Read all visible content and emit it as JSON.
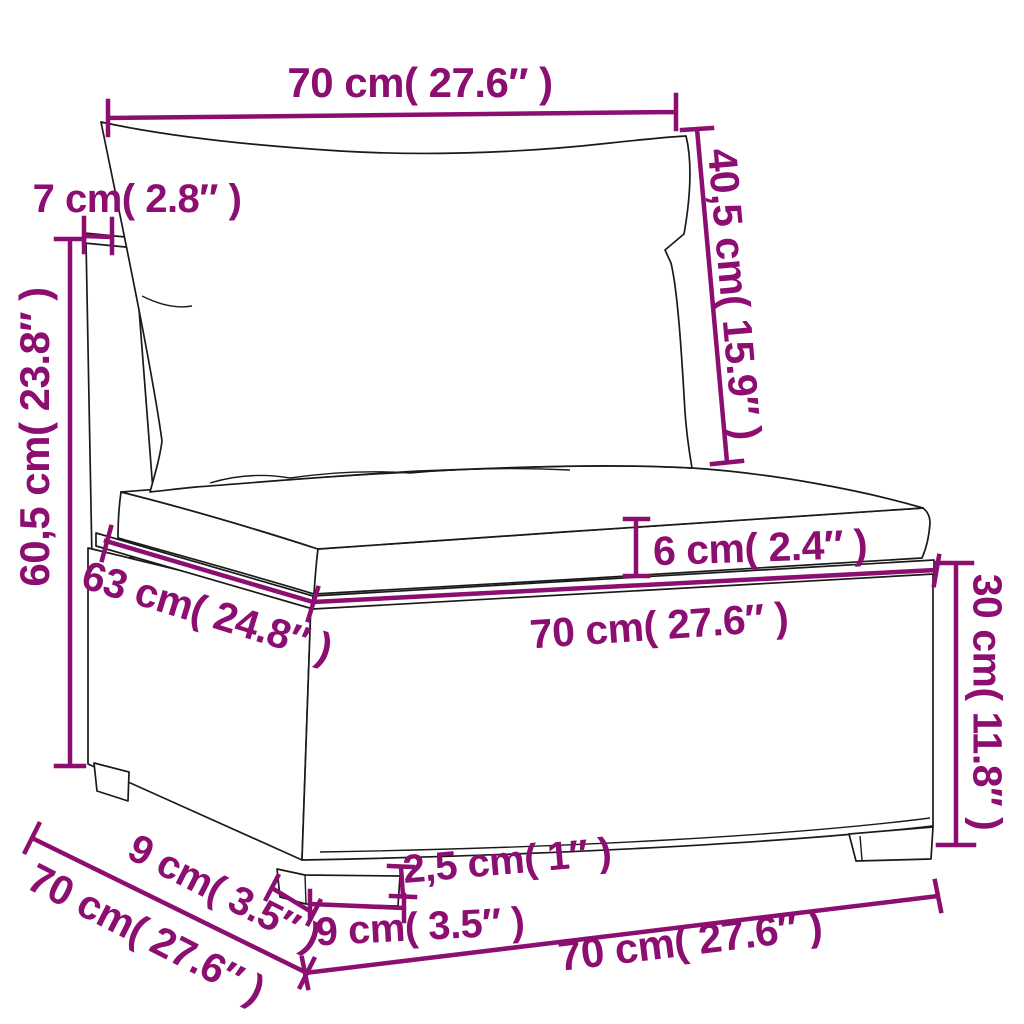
{
  "colors": {
    "accent": "#8b0e70",
    "outline": "#1a1a1a"
  },
  "diagram": {
    "subject": "rattan-sofa-middle-section-with-cushions",
    "labels": {
      "back_cushion_width": "70 cm( 27.6″ )",
      "back_panel_thickness": "7 cm( 2.8″ )",
      "back_cushion_height": "40,5 cm( 15.9″ )",
      "overall_height": "60,5 cm( 23.8″ )",
      "seat_cushion_thickness": "6 cm( 2.4″ )",
      "seat_depth": "63 cm( 24.8″ )",
      "seat_width": "70 cm( 27.6″ )",
      "base_height": "30 cm( 11.8″ )",
      "overall_depth": "70 cm( 27.6″ )",
      "leg_depth": "9 cm( 3.5″ )",
      "leg_height": "2,5 cm( 1″ )",
      "leg_width": "9 cm( 3.5″ )",
      "overall_width": "70 cm( 27.6″ )"
    }
  }
}
